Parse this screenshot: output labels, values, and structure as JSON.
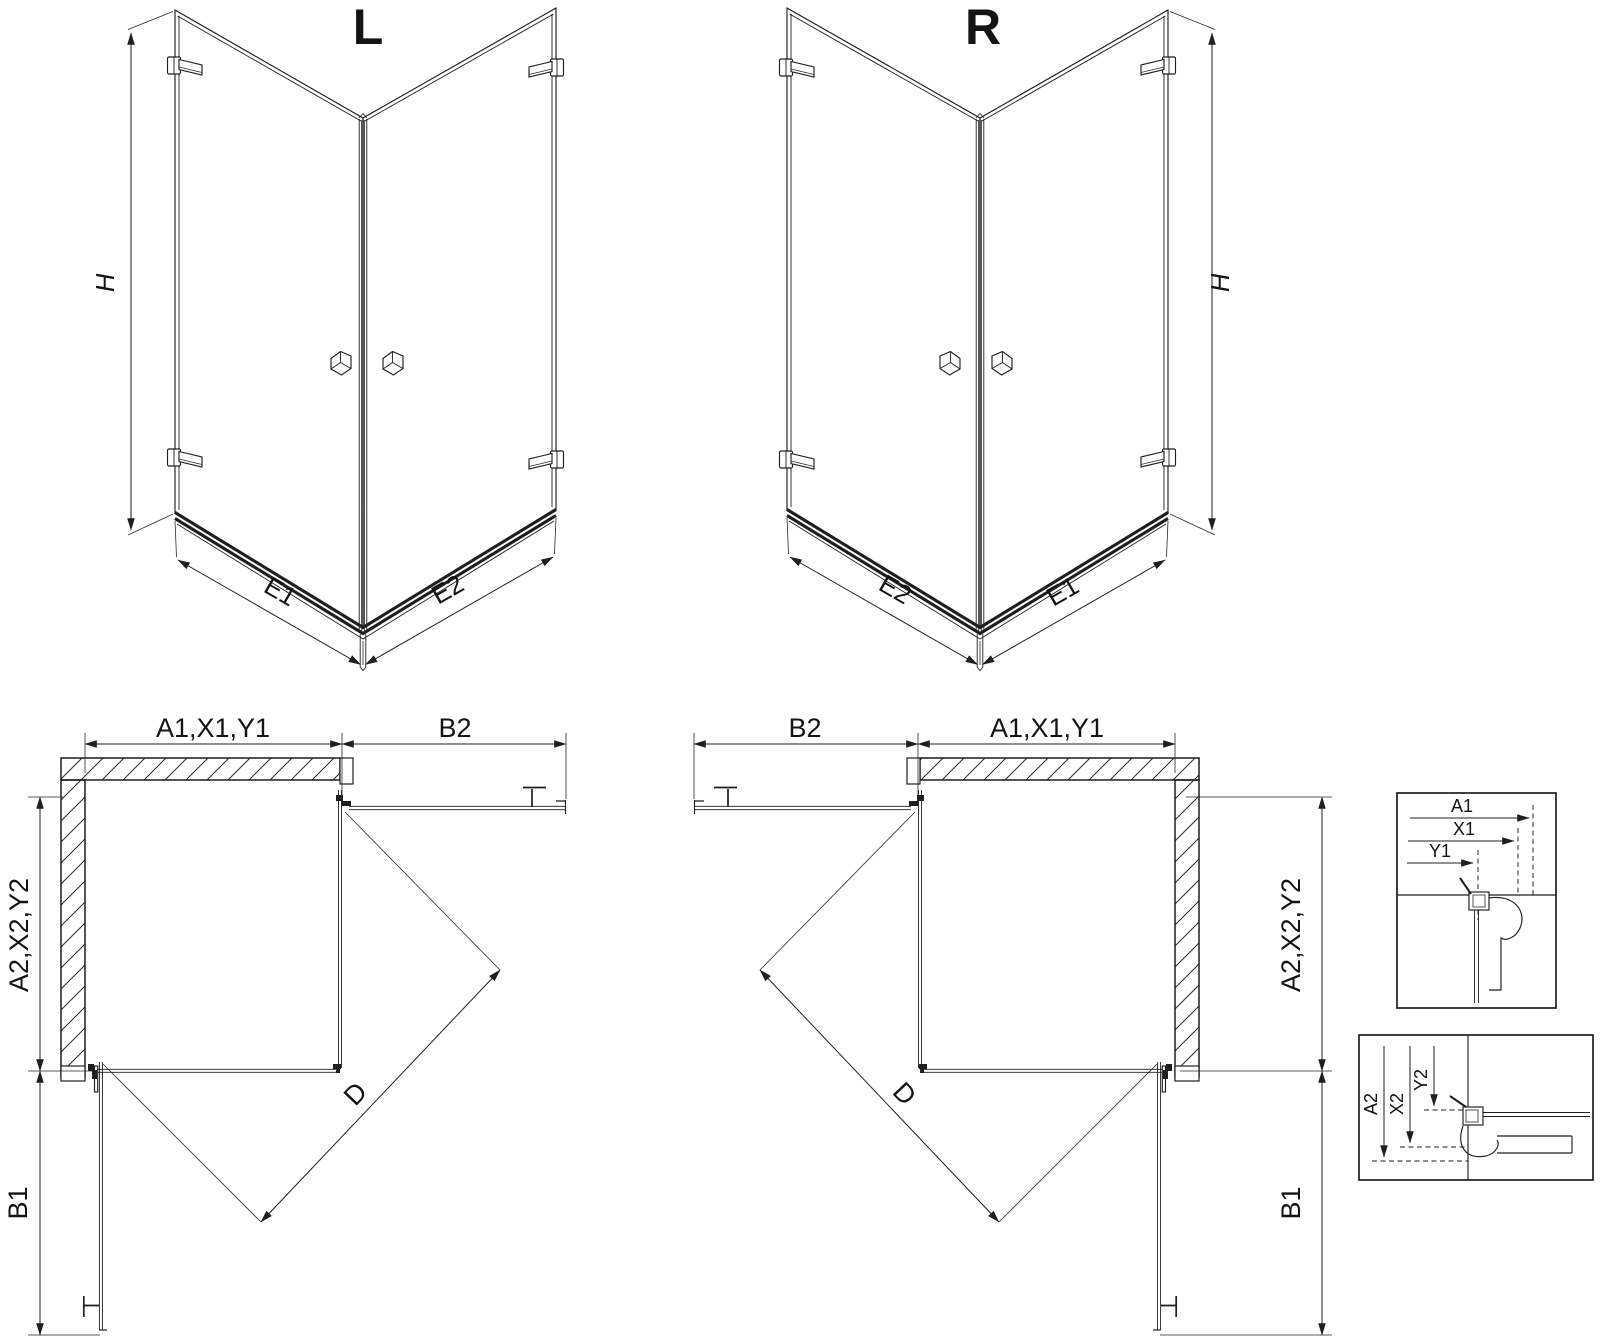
{
  "page": {
    "background": "#ffffff",
    "line_color": "#1f1f1f",
    "text_color": "#141414"
  },
  "perspective_views": {
    "left": {
      "title": "L",
      "height_label": "H",
      "edge_left_label": "E1",
      "edge_right_label": "E2"
    },
    "right": {
      "title": "R",
      "height_label": "H",
      "edge_left_label": "E2",
      "edge_right_label": "E1"
    }
  },
  "plan_views": {
    "left": {
      "top_width_label": "A1,X1,Y1",
      "top_door_label": "B2",
      "side_height_label": "A2,X2,Y2",
      "side_door_label": "B1",
      "entry_diagonal_label": "D"
    },
    "right": {
      "top_door_label": "B2",
      "top_width_label": "A1,X1,Y1",
      "side_height_label": "A2,X2,Y2",
      "side_door_label": "B1",
      "entry_diagonal_label": "D"
    }
  },
  "detail_views": {
    "wall_profile_horizontal": {
      "dim_labels": [
        "A1",
        "X1",
        "Y1"
      ]
    },
    "wall_profile_vertical": {
      "dim_labels": [
        "A2",
        "X2",
        "Y2"
      ]
    }
  }
}
